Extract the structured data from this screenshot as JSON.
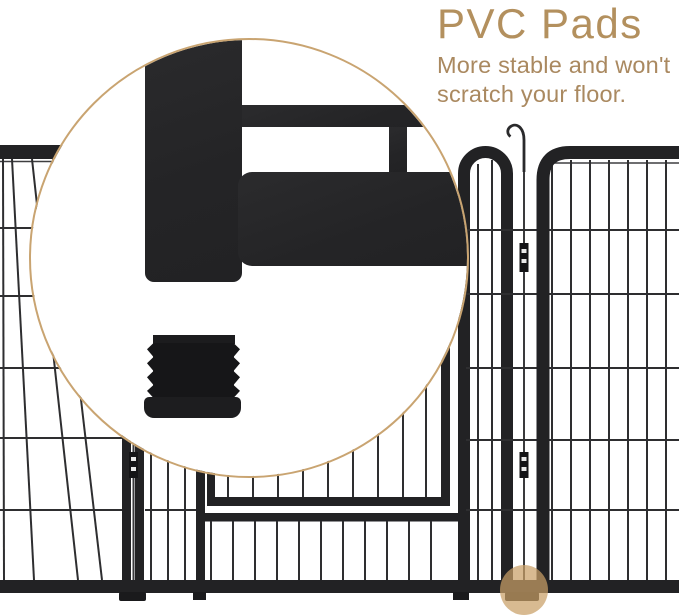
{
  "callout": {
    "title": "PVC Pads",
    "subtitle_lines": [
      "More stable and won't",
      "scratch your floor."
    ]
  },
  "colors": {
    "accent_title": "#b3905e",
    "accent_subtitle": "#aa8960",
    "ring": "#c9a471",
    "dot": "#c99f66",
    "fence": "#222224",
    "wire": "#2e2e30"
  }
}
